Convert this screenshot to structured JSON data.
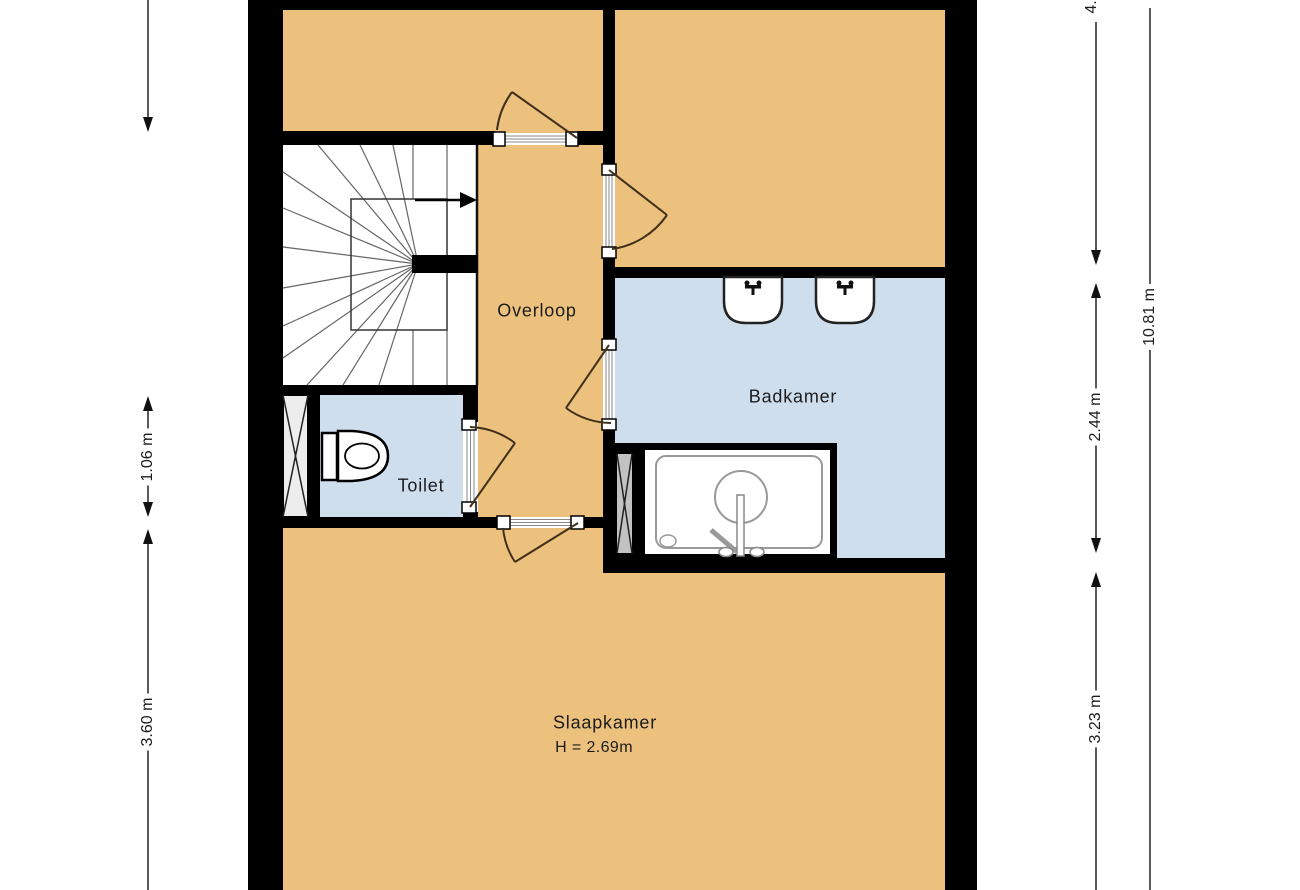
{
  "rooms": {
    "overloop": {
      "label": "Overloop"
    },
    "toilet": {
      "label": "Toilet"
    },
    "badkamer": {
      "label": "Badkamer"
    },
    "slaapkamer": {
      "label": "Slaapkamer",
      "height_note": "H = 2.69m"
    }
  },
  "dimensions": {
    "left_toilet": "1.06 m",
    "left_slaapkamer": "3.60 m",
    "right_top_partial": "4.",
    "right_badkamer": "2.44 m",
    "right_slaapkamer": "3.23 m",
    "right_total": "10.81 m"
  },
  "colors": {
    "floor_orange": "#ecc17e",
    "floor_blue": "#cfdeed",
    "wall_black": "#000000",
    "shaft_light": "#ededed",
    "shaft_gray": "#c2c2c2",
    "door_line": "#40301a",
    "dim_line": "#222222"
  },
  "icons": [
    "stairs-icon",
    "stair-direction-arrow-icon",
    "toilet-icon",
    "bathtub-icon",
    "washbasin-icon",
    "shaft-cross-icon",
    "door-swing-icon",
    "dimension-arrow-icon"
  ]
}
